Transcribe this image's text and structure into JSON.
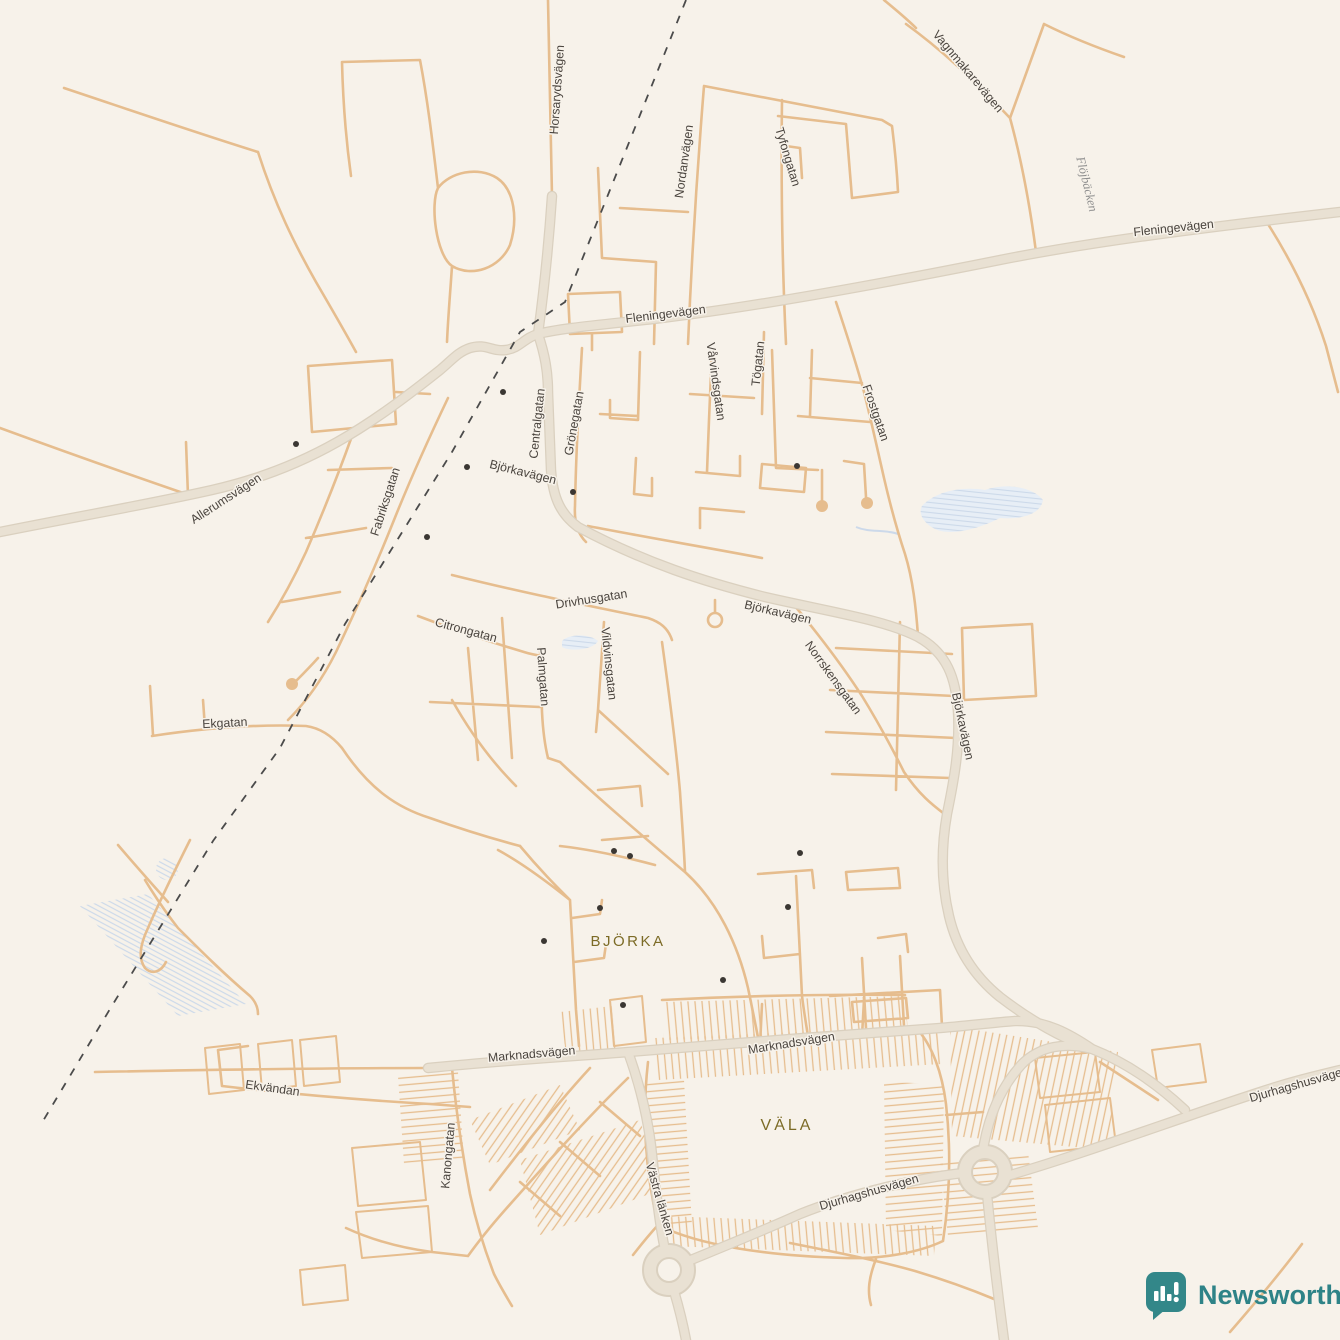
{
  "map": {
    "labels": {
      "horsarydsvagen": "Horsarydsvägen",
      "vagnmakarevagen": "Vagnmakarevägen",
      "fleningevagen": "Fleningevägen",
      "nordanvagen": "Nordanvägen",
      "tyfongatan": "Tyfongatan",
      "togatan": "Tögatan",
      "varvindsgatan": "Vårvindsgatan",
      "frostgatan": "Frostgatan",
      "allerumsvagen": "Allerumsvägen",
      "fabriksgatan": "Fabriksgatan",
      "centralgatan": "Centralgatan",
      "gronegatan": "Grönegatan",
      "bjorkavagen": "Björkavägen",
      "drivhusgatan": "Drivhusgatan",
      "vildvinsgatan": "Vildvinsgatan",
      "norrskensgatan": "Norrskensgatan",
      "citrongatan": "Citrongatan",
      "palmgatan": "Palmgatan",
      "ekgatan": "Ekgatan",
      "marknadsvagen": "Marknadsvägen",
      "ekvandan": "Ekvändan",
      "kanongatan": "Kanongatan",
      "vastra_lanken": "Västra länken",
      "djurhagshusvagen": "Djurhagshusvägen"
    },
    "places": {
      "bjorka": "BJÖRKA",
      "vala": "VÄLA"
    },
    "water": {
      "flojbacken": "Flöjbäcken"
    },
    "watermark": {
      "brand": "Newsworthy"
    },
    "colors": {
      "background": "#f7f2ea",
      "road_minor": "#e6bd8e",
      "road_major_fill": "#e9e1d3",
      "road_major_casing": "#dad0bf",
      "railway": "#4b4b4b",
      "water_fill": "#e7eef6",
      "water_hatch": "#ccd9ea",
      "road_label": "#4a443e",
      "place_label": "#7c6b26",
      "poi_dot": "#3b3733",
      "brand_teal": "#338789"
    }
  }
}
